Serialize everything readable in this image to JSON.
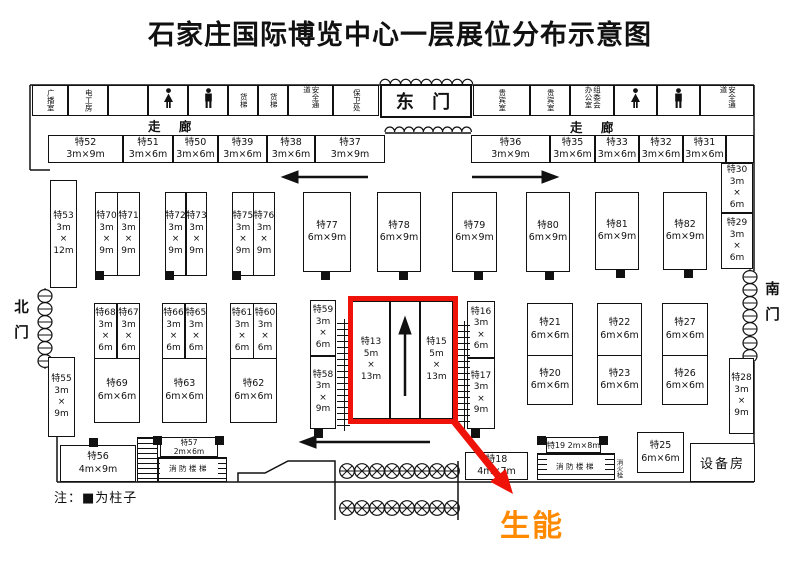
{
  "title": "石家庄国际博览中心一层展位分布示意图",
  "labels": {
    "east_gate": "东 门",
    "corridor": "走 廊",
    "north_gate": "北门",
    "south_gate": "南门",
    "fire_stairs": "消防楼梯",
    "fire_hydrant": "消火栓",
    "note": "注：■为柱子",
    "callout": "生能"
  },
  "colors": {
    "line_black": "#111111",
    "highlight_red": "#ee1208",
    "callout_orange": "#ff8a00"
  },
  "floorplan": {
    "top_rooms": [
      {
        "label": "广播室",
        "x": 32,
        "w": 36
      },
      {
        "label": "电工房",
        "x": 68,
        "w": 40
      },
      {
        "label": "",
        "x": 108,
        "w": 40
      },
      {
        "icon": "wc-female",
        "label": "",
        "x": 148,
        "w": 40
      },
      {
        "icon": "wc-male",
        "label": "",
        "x": 188,
        "w": 40
      },
      {
        "label": "货梯",
        "x": 228,
        "w": 30
      },
      {
        "label": "货梯",
        "x": 258,
        "w": 30
      },
      {
        "label": "安全通道",
        "x": 288,
        "w": 45
      },
      {
        "label": "保卫处",
        "x": 333,
        "w": 46
      },
      {
        "label": "贵宾室",
        "x": 473,
        "w": 57
      },
      {
        "label": "贵宾室",
        "x": 530,
        "w": 40
      },
      {
        "label": "组委会办公室",
        "x": 570,
        "w": 44
      },
      {
        "icon": "wc-female",
        "label": "",
        "x": 614,
        "w": 43
      },
      {
        "icon": "wc-male",
        "label": "",
        "x": 657,
        "w": 43
      },
      {
        "label": "安全通道",
        "x": 700,
        "w": 54
      }
    ],
    "booths": [
      {
        "id": "特52",
        "size": "3m×9m",
        "x": 48,
        "y": 135,
        "w": 75,
        "h": 28,
        "cls": "h"
      },
      {
        "id": "特51",
        "size": "3m×6m",
        "x": 123,
        "y": 135,
        "w": 50,
        "h": 28,
        "cls": "h"
      },
      {
        "id": "特50",
        "size": "3m×6m",
        "x": 173,
        "y": 135,
        "w": 45,
        "h": 28,
        "cls": "h"
      },
      {
        "id": "特39",
        "size": "3m×6m",
        "x": 218,
        "y": 135,
        "w": 49,
        "h": 28,
        "cls": "h"
      },
      {
        "id": "特38",
        "size": "3m×6m",
        "x": 267,
        "y": 135,
        "w": 48,
        "h": 28,
        "cls": "h"
      },
      {
        "id": "特37",
        "size": "3m×9m",
        "x": 315,
        "y": 135,
        "w": 70,
        "h": 28,
        "cls": "h"
      },
      {
        "id": "特36",
        "size": "3m×9m",
        "x": 471,
        "y": 135,
        "w": 79,
        "h": 28,
        "cls": "h"
      },
      {
        "id": "特35",
        "size": "3m×6m",
        "x": 550,
        "y": 135,
        "w": 45,
        "h": 28,
        "cls": "h"
      },
      {
        "id": "特33",
        "size": "3m×6m",
        "x": 595,
        "y": 135,
        "w": 44,
        "h": 28,
        "cls": "h"
      },
      {
        "id": "特32",
        "size": "3m×6m",
        "x": 639,
        "y": 135,
        "w": 44,
        "h": 28,
        "cls": "h"
      },
      {
        "id": "特31",
        "size": "3m×6m",
        "x": 683,
        "y": 135,
        "w": 43,
        "h": 28,
        "cls": "h"
      },
      {
        "id": "",
        "size": "",
        "x": 726,
        "y": 135,
        "w": 28,
        "h": 28,
        "cls": "h",
        "name": "empty-box"
      },
      {
        "id": "特30",
        "size": "3m×6m",
        "x": 721,
        "y": 163,
        "w": 32,
        "h": 50,
        "cls": "v"
      },
      {
        "id": "特29",
        "size": "3m×6m",
        "x": 721,
        "y": 213,
        "w": 32,
        "h": 56,
        "cls": "v"
      },
      {
        "id": "特28",
        "size": "3m×9m",
        "x": 729,
        "y": 358,
        "w": 25,
        "h": 76,
        "cls": "v"
      },
      {
        "id": "特53",
        "size": "3m×12m",
        "x": 50,
        "y": 180,
        "w": 27,
        "h": 108,
        "cls": "v"
      },
      {
        "id": "特70",
        "size": "3m×9m",
        "x": 95,
        "y": 192,
        "w": 23,
        "h": 84,
        "cls": "v"
      },
      {
        "id": "特71",
        "size": "3m×9m",
        "x": 117,
        "y": 192,
        "w": 23,
        "h": 84,
        "cls": "v"
      },
      {
        "id": "特72",
        "size": "3m×9m",
        "x": 165,
        "y": 192,
        "w": 21,
        "h": 84,
        "cls": "v"
      },
      {
        "id": "特73",
        "size": "3m×9m",
        "x": 186,
        "y": 192,
        "w": 21,
        "h": 84,
        "cls": "v"
      },
      {
        "id": "特75",
        "size": "3m×9m",
        "x": 232,
        "y": 192,
        "w": 22,
        "h": 84,
        "cls": "v"
      },
      {
        "id": "特76",
        "size": "3m×9m",
        "x": 253,
        "y": 192,
        "w": 22,
        "h": 84,
        "cls": "v"
      },
      {
        "id": "特77",
        "size": "6m×9m",
        "x": 303,
        "y": 192,
        "w": 48,
        "h": 80,
        "cls": "h"
      },
      {
        "id": "特78",
        "size": "6m×9m",
        "x": 377,
        "y": 192,
        "w": 44,
        "h": 80,
        "cls": "h"
      },
      {
        "id": "特79",
        "size": "6m×9m",
        "x": 452,
        "y": 192,
        "w": 45,
        "h": 80,
        "cls": "h"
      },
      {
        "id": "特80",
        "size": "6m×9m",
        "x": 526,
        "y": 192,
        "w": 44,
        "h": 80,
        "cls": "h"
      },
      {
        "id": "特81",
        "size": "6m×9m",
        "x": 595,
        "y": 192,
        "w": 44,
        "h": 78,
        "cls": "h"
      },
      {
        "id": "特82",
        "size": "6m×9m",
        "x": 663,
        "y": 192,
        "w": 44,
        "h": 78,
        "cls": "h"
      },
      {
        "id": "特68",
        "size": "3m×6m",
        "x": 94,
        "y": 303,
        "w": 23,
        "h": 56,
        "cls": "v"
      },
      {
        "id": "特67",
        "size": "3m×6m",
        "x": 117,
        "y": 303,
        "w": 23,
        "h": 56,
        "cls": "v"
      },
      {
        "id": "特69",
        "size": "6m×6m",
        "x": 94,
        "y": 358,
        "w": 46,
        "h": 65,
        "cls": "h"
      },
      {
        "id": "特66",
        "size": "3m×6m",
        "x": 162,
        "y": 303,
        "w": 23,
        "h": 56,
        "cls": "v"
      },
      {
        "id": "特65",
        "size": "3m×6m",
        "x": 185,
        "y": 303,
        "w": 22,
        "h": 56,
        "cls": "v"
      },
      {
        "id": "特63",
        "size": "6m×6m",
        "x": 162,
        "y": 358,
        "w": 45,
        "h": 65,
        "cls": "h"
      },
      {
        "id": "特61",
        "size": "3m×6m",
        "x": 230,
        "y": 303,
        "w": 24,
        "h": 56,
        "cls": "v"
      },
      {
        "id": "特60",
        "size": "3m×6m",
        "x": 253,
        "y": 303,
        "w": 24,
        "h": 56,
        "cls": "v"
      },
      {
        "id": "特62",
        "size": "6m×6m",
        "x": 230,
        "y": 358,
        "w": 47,
        "h": 65,
        "cls": "h"
      },
      {
        "id": "特55",
        "size": "3m×9m",
        "x": 48,
        "y": 357,
        "w": 27,
        "h": 80,
        "cls": "v"
      },
      {
        "id": "特59",
        "size": "3m×6m",
        "x": 310,
        "y": 300,
        "w": 26,
        "h": 56,
        "cls": "v"
      },
      {
        "id": "特58",
        "size": "3m×9m",
        "x": 310,
        "y": 356,
        "w": 26,
        "h": 73,
        "cls": "v"
      },
      {
        "id": "特13",
        "size": "5m×13m",
        "x": 352,
        "y": 301,
        "w": 38,
        "h": 118,
        "cls": "v"
      },
      {
        "id": "",
        "size": "",
        "x": 390,
        "y": 301,
        "w": 30,
        "h": 118,
        "cls": "v",
        "name": "aisle-cell"
      },
      {
        "id": "特15",
        "size": "5m×13m",
        "x": 420,
        "y": 301,
        "w": 33,
        "h": 118,
        "cls": "v"
      },
      {
        "id": "特16",
        "size": "3m×6m",
        "x": 467,
        "y": 301,
        "w": 28,
        "h": 57,
        "cls": "v"
      },
      {
        "id": "特17",
        "size": "3m×9m",
        "x": 467,
        "y": 358,
        "w": 28,
        "h": 71,
        "cls": "v"
      },
      {
        "id": "特21",
        "size": "6m×6m",
        "x": 527,
        "y": 303,
        "w": 46,
        "h": 53,
        "cls": "h"
      },
      {
        "id": "特20",
        "size": "6m×6m",
        "x": 527,
        "y": 355,
        "w": 46,
        "h": 50,
        "cls": "h"
      },
      {
        "id": "特22",
        "size": "6m×6m",
        "x": 597,
        "y": 303,
        "w": 45,
        "h": 53,
        "cls": "h"
      },
      {
        "id": "特23",
        "size": "6m×6m",
        "x": 597,
        "y": 355,
        "w": 45,
        "h": 50,
        "cls": "h"
      },
      {
        "id": "特27",
        "size": "6m×6m",
        "x": 662,
        "y": 303,
        "w": 46,
        "h": 53,
        "cls": "h"
      },
      {
        "id": "特26",
        "size": "6m×6m",
        "x": 662,
        "y": 355,
        "w": 46,
        "h": 50,
        "cls": "h"
      },
      {
        "id": "特56",
        "size": "4m×9m",
        "x": 60,
        "y": 445,
        "w": 76,
        "h": 37,
        "cls": "h"
      },
      {
        "id": "特57",
        "size": "2m×6m",
        "x": 160,
        "y": 437,
        "w": 58,
        "h": 20,
        "cls": "tiny"
      },
      {
        "id": "特18",
        "size": "4m×7m",
        "x": 465,
        "y": 452,
        "w": 63,
        "h": 28,
        "cls": "h"
      },
      {
        "id": "特19",
        "size": "2m×8m",
        "x": 546,
        "y": 437,
        "w": 55,
        "h": 16,
        "cls": "inline"
      },
      {
        "id": "特25",
        "size": "6m×6m",
        "x": 637,
        "y": 432,
        "w": 47,
        "h": 41,
        "cls": "h"
      },
      {
        "id": "设备房",
        "size": "",
        "x": 690,
        "y": 443,
        "w": 65,
        "h": 39,
        "cls": "room",
        "name": "equipment-room"
      }
    ],
    "pillars": [
      [
        95,
        271
      ],
      [
        165,
        271
      ],
      [
        232,
        271
      ],
      [
        321,
        271
      ],
      [
        399,
        271
      ],
      [
        474,
        271
      ],
      [
        545,
        271
      ],
      [
        616,
        269
      ],
      [
        684,
        269
      ],
      [
        314,
        429
      ],
      [
        471,
        429
      ],
      [
        89,
        438
      ],
      [
        153,
        436
      ],
      [
        215,
        436
      ],
      [
        537,
        436
      ],
      [
        599,
        436
      ]
    ]
  }
}
